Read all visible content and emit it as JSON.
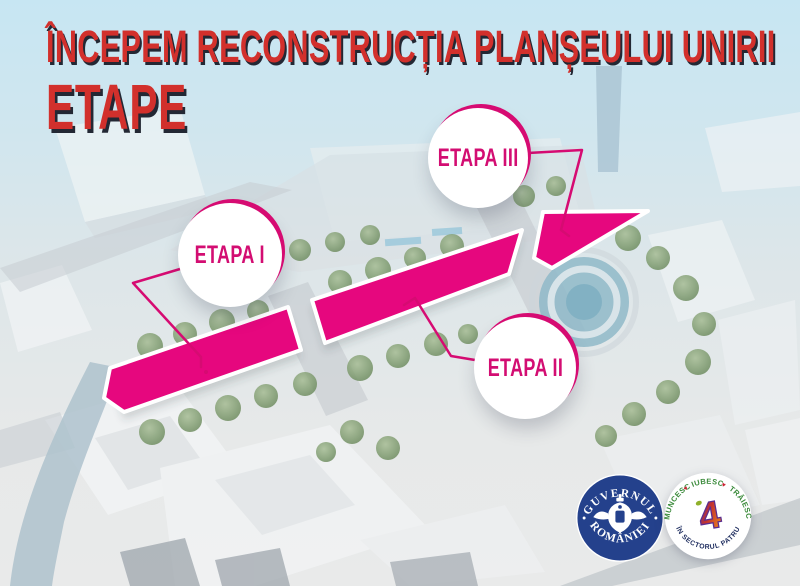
{
  "title": {
    "text": "ÎNCEPEM RECONSTRUCȚIA PLANȘEULUI UNIRII",
    "subtitle": "ETAPE"
  },
  "stages": [
    {
      "label": "ETAPA I"
    },
    {
      "label": "ETAPA II"
    },
    {
      "label": "ETAPA III"
    }
  ],
  "logos": {
    "government": {
      "arc_top": "GUVERNUL",
      "arc_bottom": "ROMÂNIEI"
    },
    "sector4": {
      "word_1": "MUNCESC",
      "word_2": "IUBESC",
      "word_3": "TRĂIESC",
      "separator": "♥",
      "arc_bottom": "ÎN SECTORUL PATRU",
      "center_glyph": "4"
    }
  },
  "colors": {
    "title_red": "#d2302c",
    "title_shadow": "#232834",
    "stage_magenta": "#e6077e",
    "badge_ring_magenta": "#d60b72",
    "badge_text_magenta": "#d30d72",
    "gov_navy": "#24418c",
    "sector4_green": "#3a8a3a",
    "sector4_navy": "#1d2c5e",
    "heart_red": "#cc2233",
    "sky_blue": "#c7e6f3",
    "water_blue": "#aec2cd",
    "tree_green": "#7d9a6d"
  }
}
